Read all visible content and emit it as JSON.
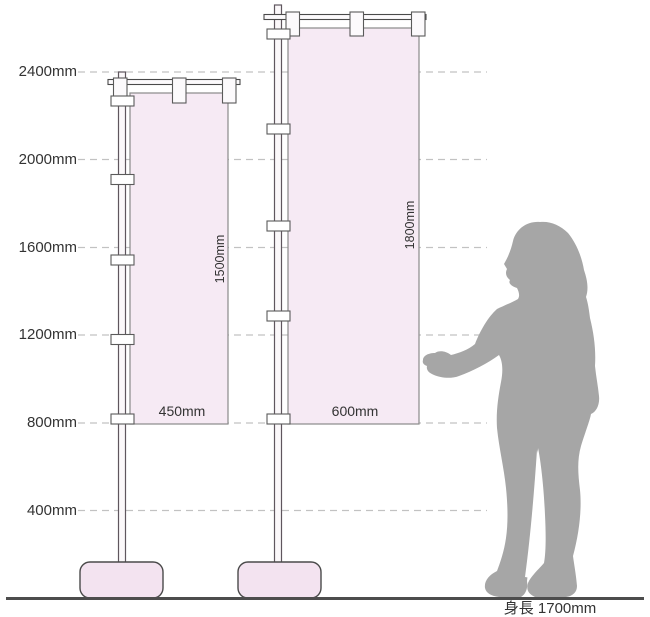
{
  "diagram": {
    "type": "dimension-diagram",
    "subject": "Nobori banner flag sizes compared with person height"
  },
  "scale": {
    "unit": "mm",
    "gridlines": [
      {
        "label": "2400mm",
        "value": 2400
      },
      {
        "label": "2000mm",
        "value": 2000
      },
      {
        "label": "1600mm",
        "value": 1600
      },
      {
        "label": "1200mm",
        "value": 1200
      },
      {
        "label": "800mm",
        "value": 800
      },
      {
        "label": "400mm",
        "value": 400
      }
    ]
  },
  "flags": [
    {
      "id": "flag-small",
      "width_label": "450mm",
      "height_label": "1500mm",
      "width_mm": 450,
      "height_mm": 1500
    },
    {
      "id": "flag-large",
      "width_label": "600mm",
      "height_label": "1800mm",
      "width_mm": 600,
      "height_mm": 1800
    }
  ],
  "person": {
    "height_label": "身長 1700mm",
    "height_mm": 1700
  },
  "colors": {
    "flag_fill": "#f6eaf4",
    "flag_border": "#8a8a8a",
    "base_fill": "#f3e3f0",
    "dark_outline": "#4a4a4a",
    "pole_outline": "#5f565e",
    "gridline": "#c2c2c2",
    "ground": "#4d4d4d",
    "silhouette": "#a6a6a6",
    "text": "#333333"
  }
}
